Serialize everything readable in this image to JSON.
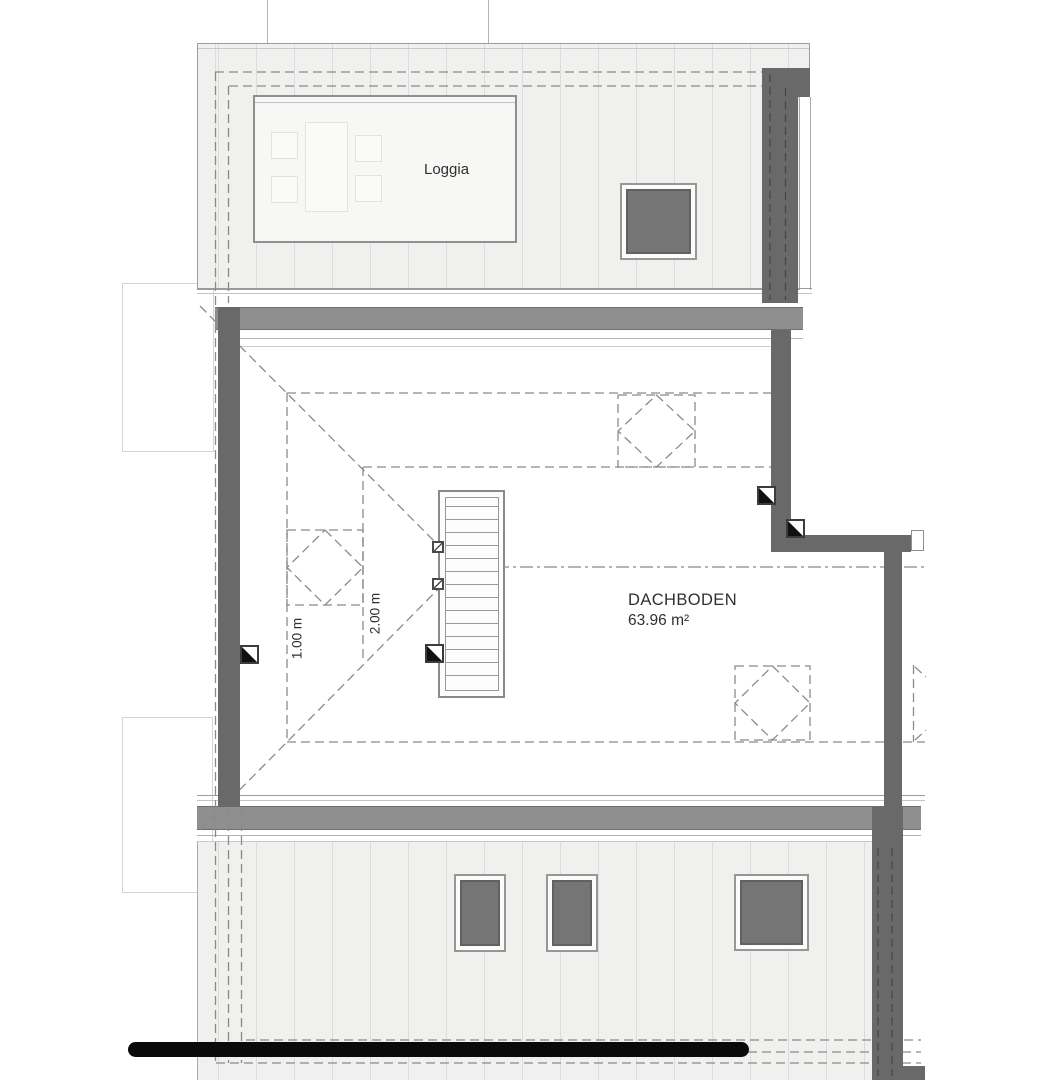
{
  "plan": {
    "labels": {
      "loggia": "Loggia",
      "room_name": "DACHBODEN",
      "room_area": "63.96 m²",
      "dim_1": "1.00 m",
      "dim_2": "2.00 m"
    },
    "colors": {
      "wall_dark": "#696969",
      "eave_band": "#8f8f8f",
      "roof_fill": "#f0f0ee",
      "hatch_line": "#dcdcdc",
      "dash_line": "#8a8a8a",
      "window_glass": "#757575",
      "scale_bar": "#0a0a0a",
      "text": "#2f2f2f"
    },
    "symbols": {
      "skylight_count_dashed": 4,
      "roof_window_count": 4,
      "column_marker_count": 4
    }
  }
}
